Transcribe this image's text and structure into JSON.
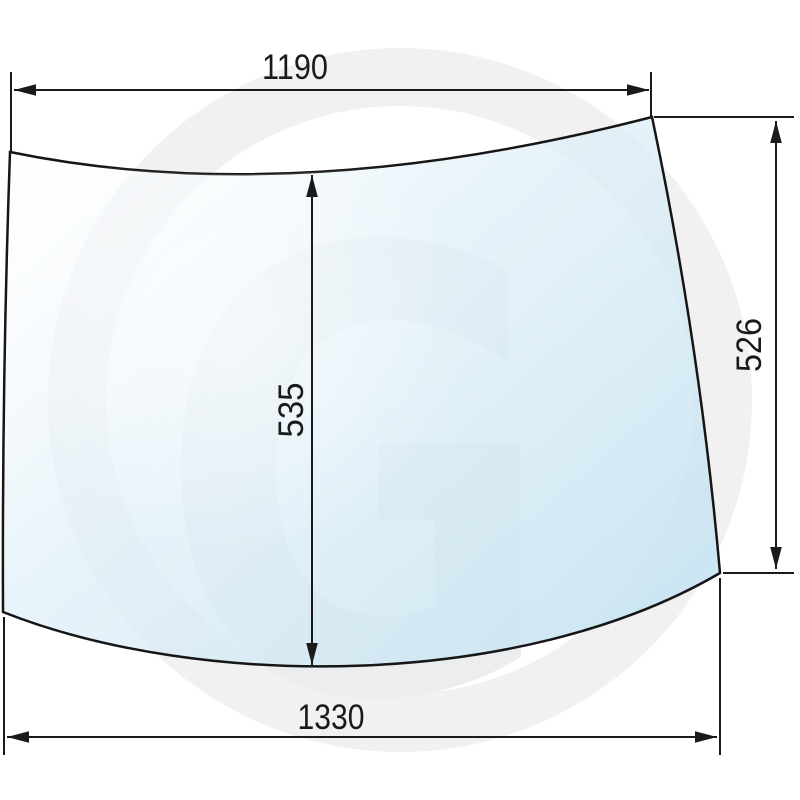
{
  "canvas": {
    "background": "#ffffff",
    "width_px": 800,
    "height_px": 800
  },
  "watermark": {
    "letter": "G",
    "ring_color": "#f1f1f2",
    "letter_color": "#ebedee"
  },
  "glass": {
    "outline_color": "#1a1a1a",
    "fill_light": "#fbfdfe",
    "fill_mid": "#e2f0f8",
    "fill_deep": "#c8e4f2"
  },
  "dimensions": {
    "line_color": "#1a1a1a",
    "top_width": {
      "label": "1190",
      "orientation": "horizontal"
    },
    "center_height": {
      "label": "535",
      "orientation": "vertical"
    },
    "right_height": {
      "label": "526",
      "orientation": "vertical"
    },
    "bottom_width": {
      "label": "1330",
      "orientation": "horizontal"
    }
  }
}
